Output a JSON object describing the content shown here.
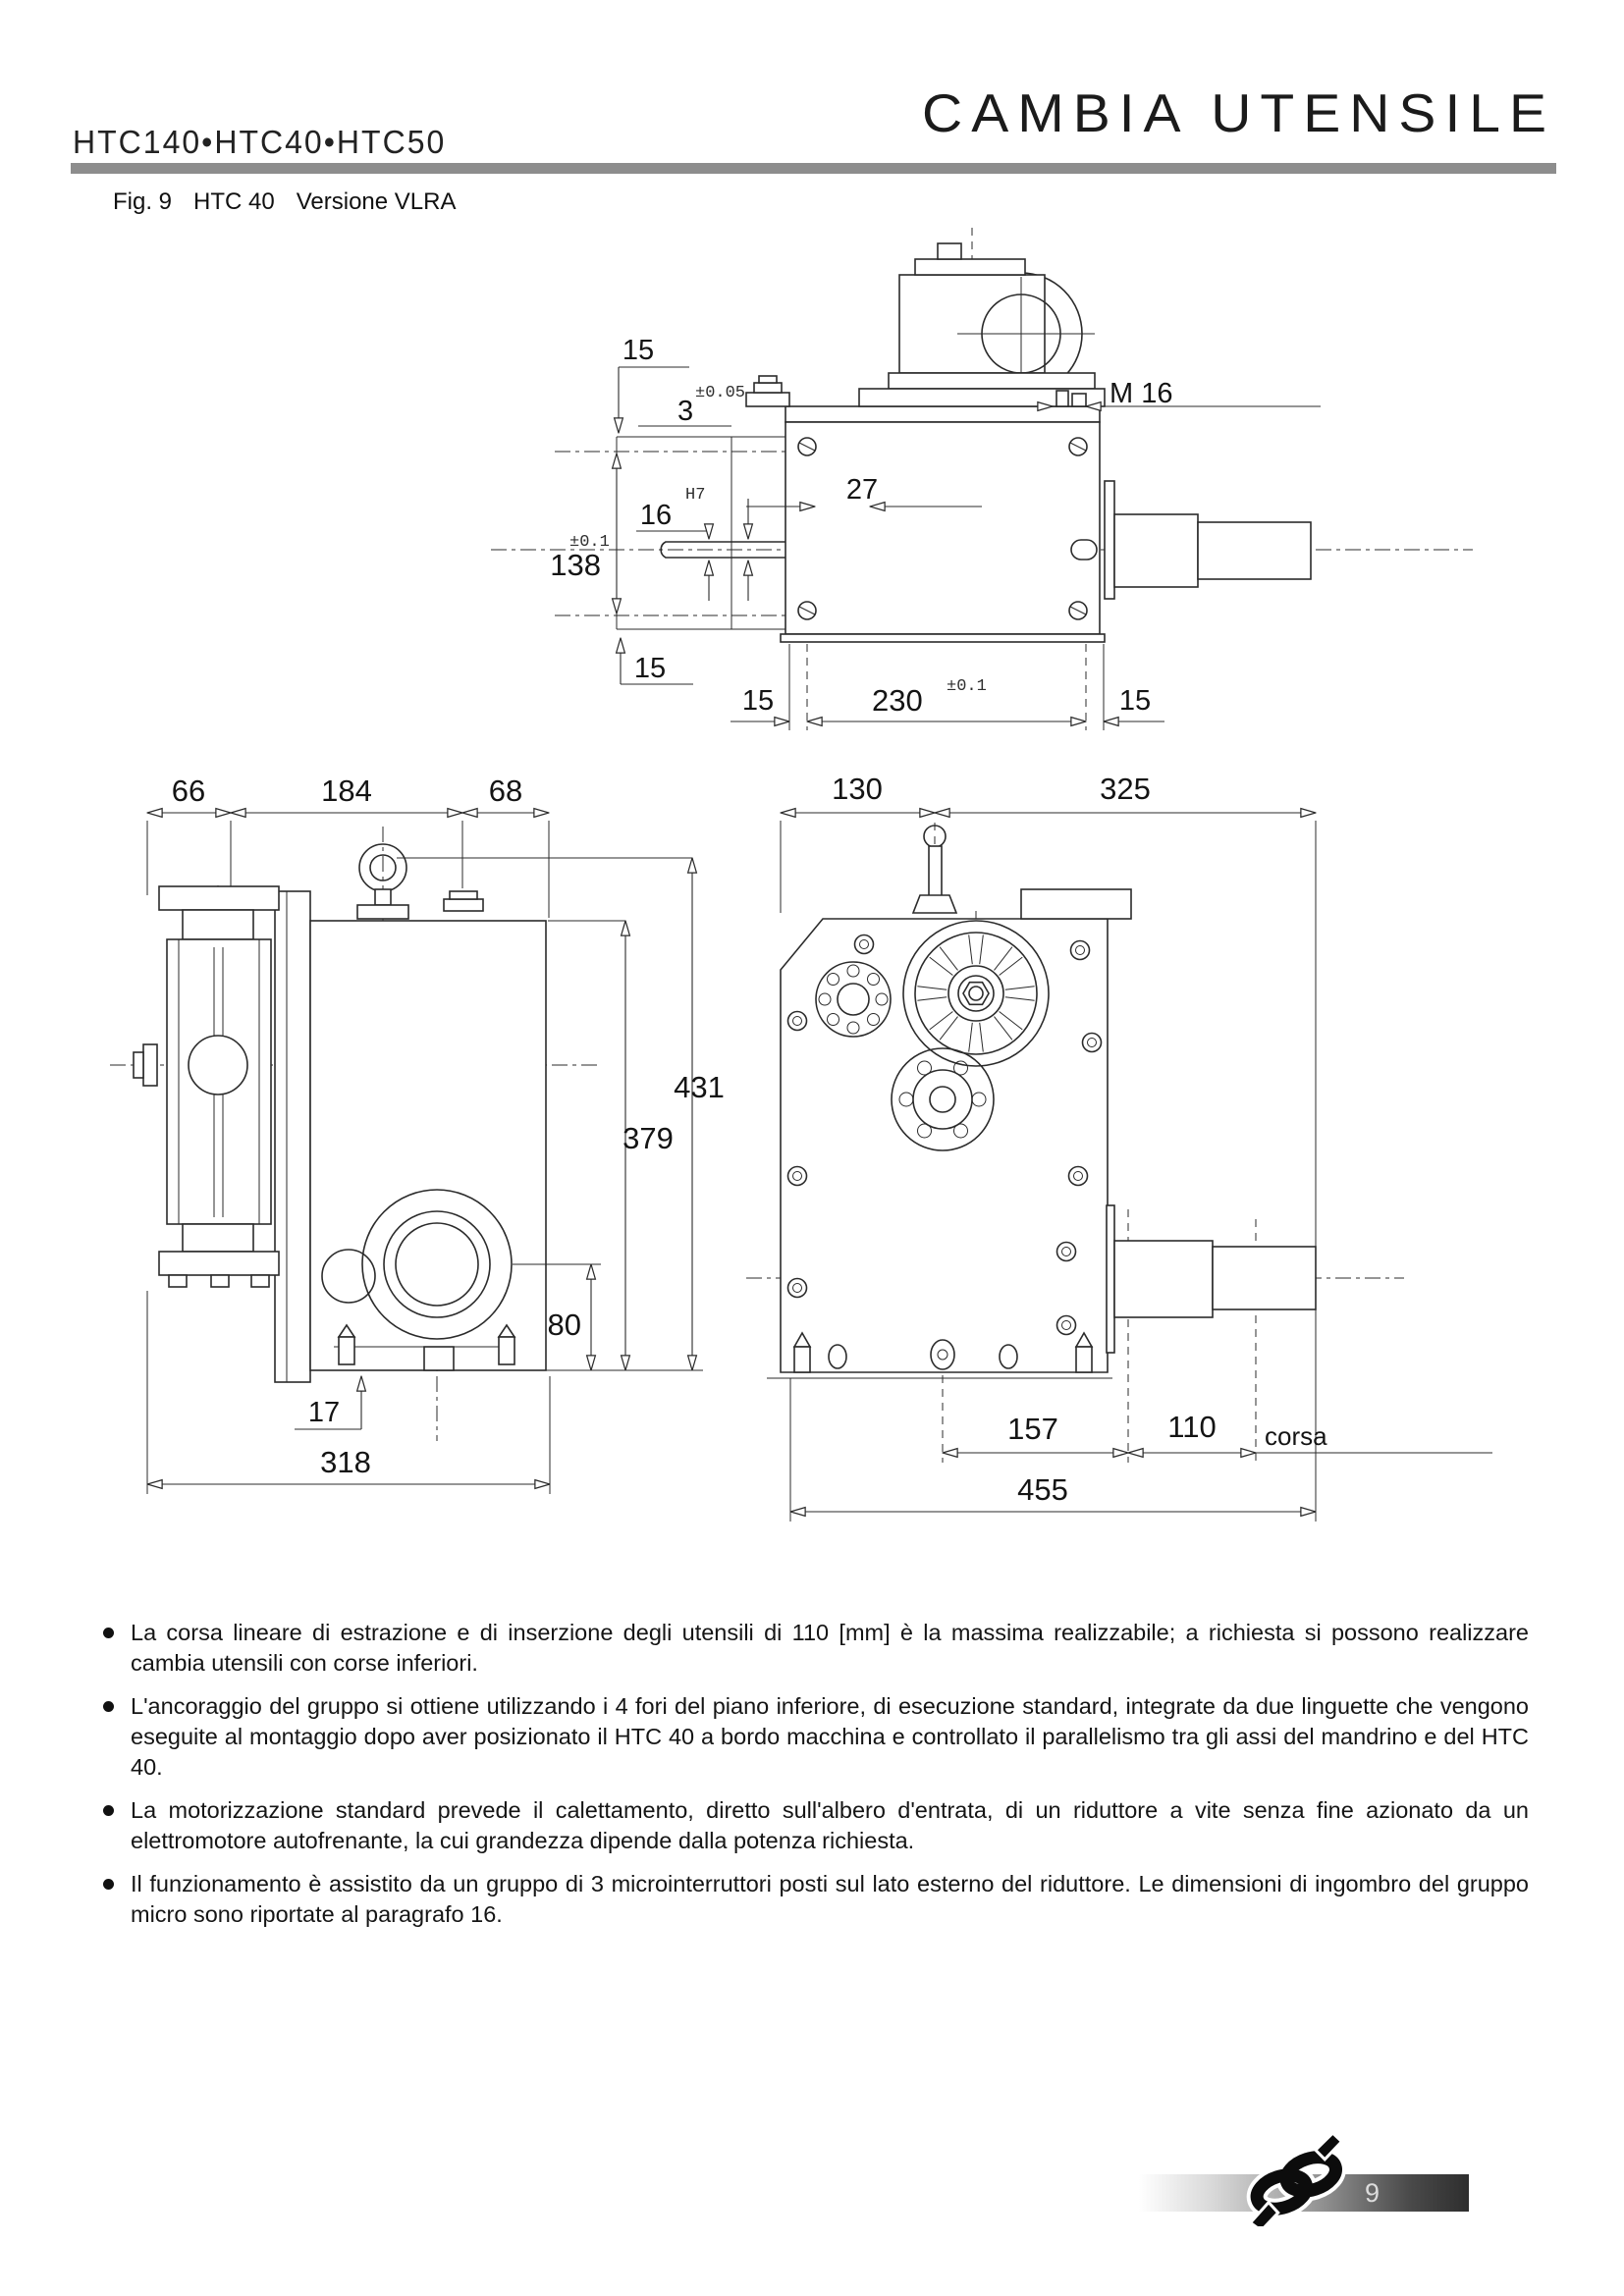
{
  "header": {
    "models": "HTC140•HTC40•HTC50",
    "title": "CAMBIA UTENSILE"
  },
  "figure_caption": {
    "fig": "Fig. 9",
    "model": "HTC 40",
    "version": "Versione VLRA"
  },
  "drawings": {
    "side_view": {
      "d15_top": "15",
      "d3": "3",
      "d3_tol": "±0.05",
      "m16": "M 16",
      "d16": "16",
      "d16_fit": "H7",
      "d27": "27",
      "d138": "138",
      "d138_tol": "±0.1",
      "d15_mid": "15",
      "d15_bl": "15",
      "d230": "230",
      "d230_tol": "±0.1",
      "d15_br": "15"
    },
    "front_view": {
      "d66": "66",
      "d184": "184",
      "d68": "68",
      "d431": "431",
      "d379": "379",
      "d80": "80",
      "d17": "17",
      "d318": "318"
    },
    "rear_view": {
      "d130": "130",
      "d325": "325",
      "d157": "157",
      "d110": "110",
      "corsa_label": "corsa",
      "d455": "455"
    }
  },
  "bullets": [
    {
      "text": "La corsa lineare di estrazione e di inserzione degli utensili di 110 [mm] è la massima realizzabile; a richiesta si possono realizzare cambia utensili con corse inferiori."
    },
    {
      "text": "L'ancoraggio del gruppo si ottiene utilizzando i 4 fori del piano inferiore, di esecuzione standard, integrate da due linguette che vengono eseguite al montaggio dopo aver posizionato il HTC 40 a bordo macchina e controllato il parallelismo tra gli assi del mandrino e del HTC 40."
    },
    {
      "text": "La motorizzazione standard prevede il calettamento, diretto sull'albero d'entrata, di un riduttore a vite senza fine azionato da un elettromotore autofrenante, la cui grandezza dipende dalla potenza richiesta."
    },
    {
      "text": "Il funzionamento è assistito da un gruppo di 3 microinterruttori posti sul lato esterno del riduttore. Le dimensioni di ingombro del gruppo micro sono riportate al paragrafo 16."
    }
  ],
  "footer": {
    "page": "9"
  }
}
